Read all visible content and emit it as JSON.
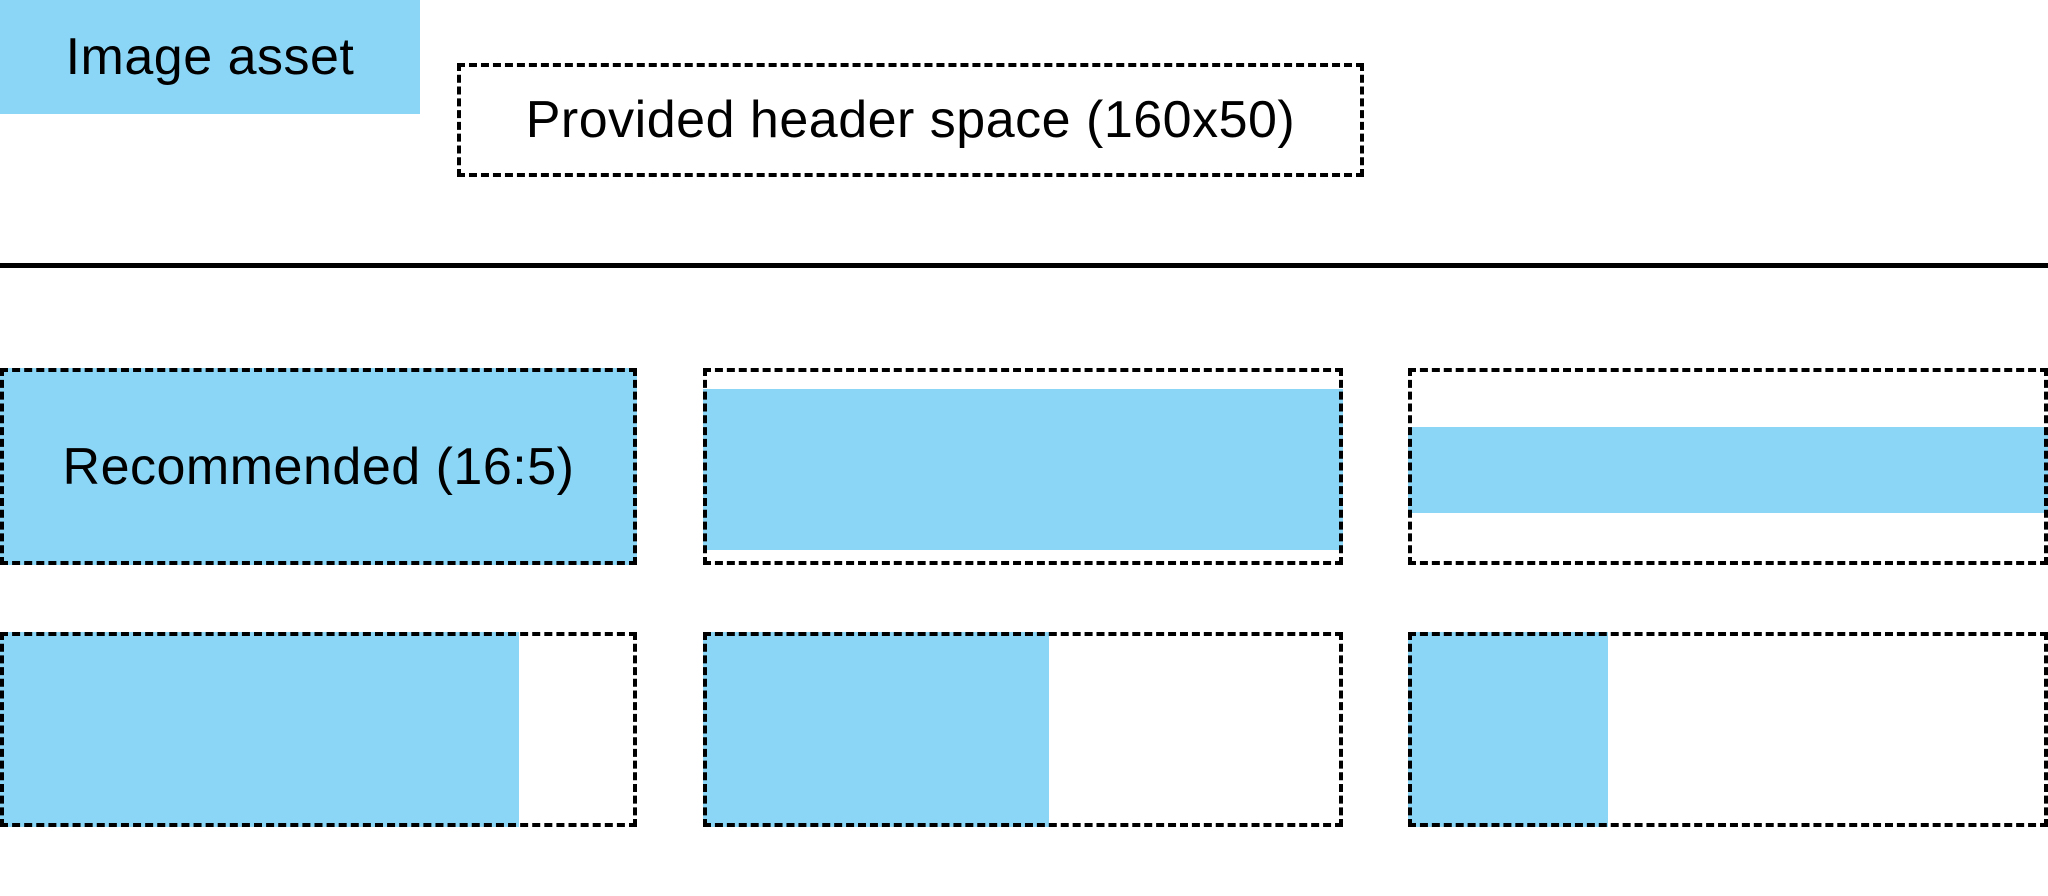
{
  "colors": {
    "image_asset_blue": "#8BD6F6",
    "outline_black": "#000000",
    "background": "#FFFFFF"
  },
  "legend": {
    "image_asset_label": "Image asset",
    "header_space_label": "Provided header space (160x50)"
  },
  "examples": {
    "recommended_label": "Recommended (16:5)",
    "tiles": [
      {
        "name": "recommended-16-5",
        "fill": {
          "left": 0,
          "top": 0,
          "width": 100,
          "height": 100
        }
      },
      {
        "name": "full-width-reduced-height",
        "fill": {
          "left": 0,
          "top": 10.7,
          "width": 100,
          "height": 81.7
        }
      },
      {
        "name": "full-width-thin-strip",
        "fill": {
          "left": 0,
          "top": 30,
          "width": 100,
          "height": 43.7
        }
      },
      {
        "name": "partial-width-82-percent",
        "fill": {
          "left": 0,
          "top": 0,
          "width": 81.5,
          "height": 100
        }
      },
      {
        "name": "partial-width-54-percent",
        "fill": {
          "left": 0,
          "top": 0,
          "width": 54,
          "height": 100
        }
      },
      {
        "name": "partial-width-31-percent",
        "fill": {
          "left": 0,
          "top": 0,
          "width": 31.3,
          "height": 100
        }
      }
    ]
  }
}
